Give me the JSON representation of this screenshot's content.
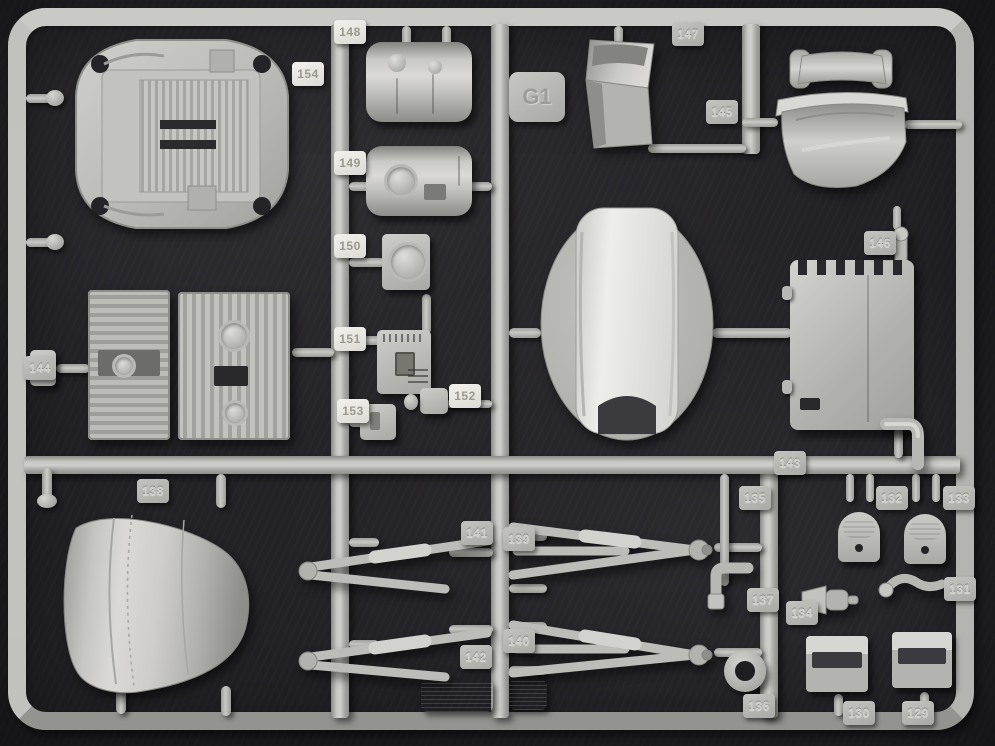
{
  "description": "Photograph of a gray injection-molded plastic model kit sprue (parts tree) on a dark background",
  "colors": {
    "background": "#232226",
    "plastic": "#b7b7b3",
    "plastic_bright": "#d8d7d3",
    "plastic_shadow": "#84847f",
    "tab_light_bg": "#ebe9e3",
    "tab_light_text": "#99998f",
    "tab_embossed_text": "#cfcfca",
    "dark_hole": "#242327"
  },
  "gate_tab": {
    "label": "G1"
  },
  "part_tags": [
    {
      "label": "148",
      "x": 334,
      "y": 20,
      "variant": "light"
    },
    {
      "label": "154",
      "x": 292,
      "y": 62,
      "variant": "light"
    },
    {
      "label": "149",
      "x": 334,
      "y": 151,
      "variant": "light"
    },
    {
      "label": "150",
      "x": 334,
      "y": 234,
      "variant": "light"
    },
    {
      "label": "151",
      "x": 334,
      "y": 327,
      "variant": "light"
    },
    {
      "label": "153",
      "x": 337,
      "y": 399,
      "variant": "light"
    },
    {
      "label": "152",
      "x": 449,
      "y": 384,
      "variant": "light"
    },
    {
      "label": "147",
      "x": 672,
      "y": 22,
      "variant": "emboss"
    },
    {
      "label": "145",
      "x": 706,
      "y": 100,
      "variant": "emboss"
    },
    {
      "label": "146",
      "x": 864,
      "y": 231,
      "variant": "emboss"
    },
    {
      "label": "144",
      "x": 24,
      "y": 356,
      "variant": "emboss"
    },
    {
      "label": "143",
      "x": 774,
      "y": 451,
      "variant": "emboss"
    },
    {
      "label": "135",
      "x": 739,
      "y": 486,
      "variant": "emboss"
    },
    {
      "label": "132",
      "x": 876,
      "y": 486,
      "variant": "emboss"
    },
    {
      "label": "133",
      "x": 943,
      "y": 486,
      "variant": "emboss"
    },
    {
      "label": "138",
      "x": 137,
      "y": 479,
      "variant": "emboss"
    },
    {
      "label": "141",
      "x": 461,
      "y": 521,
      "variant": "emboss"
    },
    {
      "label": "139",
      "x": 503,
      "y": 527,
      "variant": "emboss"
    },
    {
      "label": "142",
      "x": 460,
      "y": 645,
      "variant": "emboss"
    },
    {
      "label": "140",
      "x": 503,
      "y": 629,
      "variant": "emboss"
    },
    {
      "label": "137",
      "x": 747,
      "y": 588,
      "variant": "emboss"
    },
    {
      "label": "134",
      "x": 786,
      "y": 601,
      "variant": "emboss"
    },
    {
      "label": "131",
      "x": 944,
      "y": 577,
      "variant": "emboss"
    },
    {
      "label": "136",
      "x": 743,
      "y": 694,
      "variant": "emboss"
    },
    {
      "label": "130",
      "x": 843,
      "y": 701,
      "variant": "emboss"
    },
    {
      "label": "129",
      "x": 902,
      "y": 701,
      "variant": "emboss"
    }
  ]
}
